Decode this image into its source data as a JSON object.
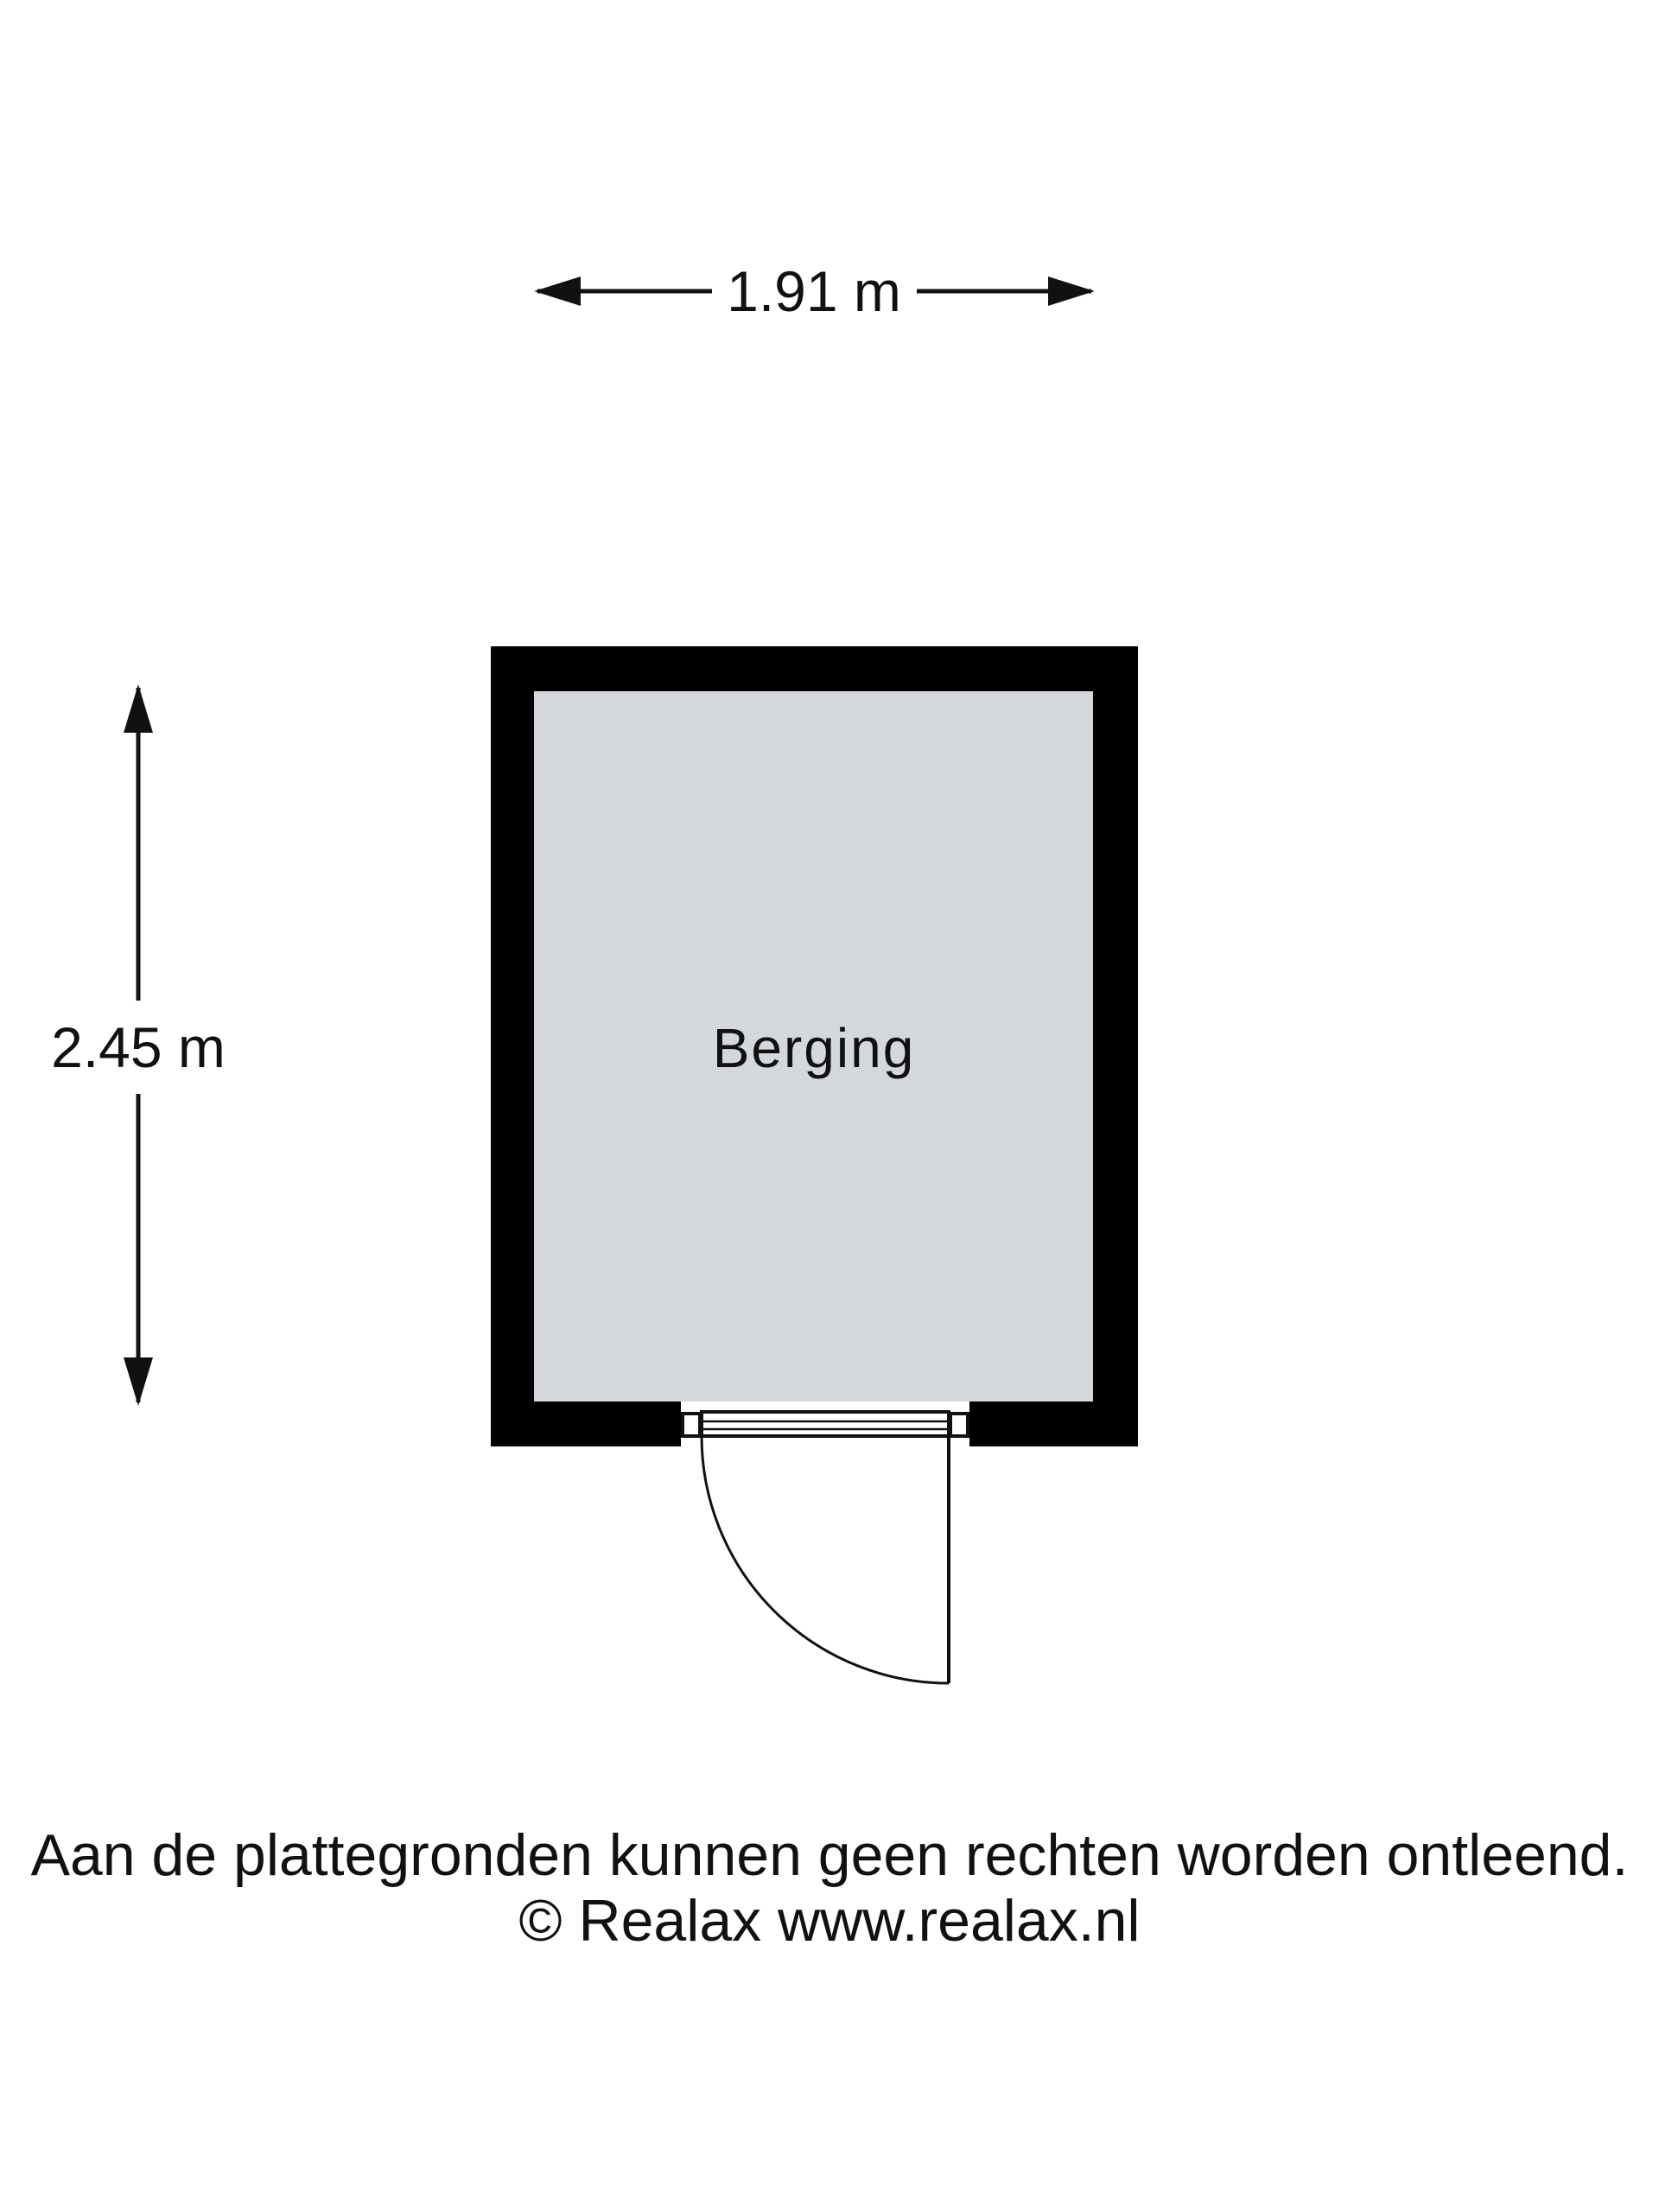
{
  "figure": {
    "type": "floorplan",
    "room": {
      "label": "Berging"
    },
    "dimensions": {
      "width_label": "1.91 m",
      "height_label": "2.45 m"
    },
    "footer": {
      "disclaimer": "Aan de plattegronden kunnen geen rechten worden ontleend.",
      "credit": "© Realax www.realax.nl"
    },
    "colors": {
      "wall": "#000000",
      "floor": "#d4d8dc",
      "line": "#111111",
      "background": "#ffffff"
    }
  }
}
